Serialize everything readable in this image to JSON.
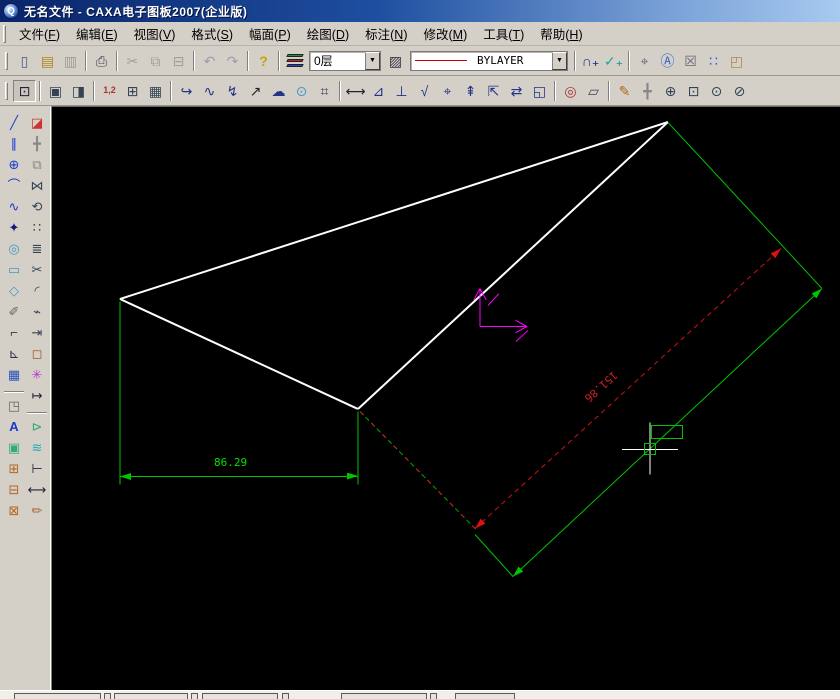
{
  "window": {
    "title": "无名文件 - CAXA电子图板2007(企业版)",
    "app_icon_glyph": "Q"
  },
  "menu": {
    "items": [
      {
        "pre": "文件(",
        "key": "F",
        "post": ")",
        "id": "file"
      },
      {
        "pre": "编辑(",
        "key": "E",
        "post": ")",
        "id": "edit"
      },
      {
        "pre": "视图(",
        "key": "V",
        "post": ")",
        "id": "view"
      },
      {
        "pre": "格式(",
        "key": "S",
        "post": ")",
        "id": "format"
      },
      {
        "pre": "幅面(",
        "key": "P",
        "post": ")",
        "id": "paper"
      },
      {
        "pre": "绘图(",
        "key": "D",
        "post": ")",
        "id": "draw"
      },
      {
        "pre": "标注(",
        "key": "N",
        "post": ")",
        "id": "dimension"
      },
      {
        "pre": "修改(",
        "key": "M",
        "post": ")",
        "id": "modify"
      },
      {
        "pre": "工具(",
        "key": "T",
        "post": ")",
        "id": "tools"
      },
      {
        "pre": "帮助(",
        "key": "H",
        "post": ")",
        "id": "help"
      }
    ]
  },
  "combos": {
    "layer": "0层",
    "linetype": "BYLAYER"
  },
  "colors": {
    "accent_green": "#00c400",
    "dim_text_green": "#00e400",
    "red": "#cc2222",
    "magenta": "#ff00ff",
    "white": "#ffffff",
    "linetype_sample": "#cc0000",
    "layer_icon": [
      "#2a8f2a",
      "#bb2222",
      "#2244cc"
    ]
  },
  "toolbar1": {
    "items": [
      {
        "n": "new-file-button",
        "g": "▯",
        "c": "#4a5a8a"
      },
      {
        "n": "open-file-button",
        "g": "▤",
        "c": "#b08820"
      },
      {
        "n": "save-file-button",
        "g": "▥",
        "c": "#707070",
        "gr": 1
      },
      {
        "sep": 1
      },
      {
        "n": "print-button",
        "g": "⎙",
        "c": "#445"
      },
      {
        "sep": 1
      },
      {
        "n": "cut-button",
        "g": "✂",
        "c": "#777",
        "gr": 1
      },
      {
        "n": "copy-button",
        "g": "⧉",
        "c": "#777",
        "gr": 1
      },
      {
        "n": "paste-button",
        "g": "⊟",
        "c": "#777",
        "gr": 1
      },
      {
        "sep": 1
      },
      {
        "n": "undo-button",
        "g": "↶",
        "c": "#6a74a0",
        "gr": 1
      },
      {
        "n": "redo-button",
        "g": "↷",
        "c": "#6a74a0",
        "gr": 1
      },
      {
        "sep": 1
      },
      {
        "n": "help-button",
        "g": "?",
        "c": "#c9a400",
        "bold": 1
      },
      {
        "sep": 1
      },
      {
        "type": "layers",
        "n": "layer-manager-button"
      },
      {
        "type": "combo",
        "n": "layer-combo",
        "bind": "combos.layer",
        "w": 72
      },
      {
        "n": "linetype-manager-button",
        "g": "▨",
        "c": "#334"
      },
      {
        "type": "combo",
        "n": "linetype-combo",
        "bind": "combos.linetype",
        "w": 158,
        "line": 1
      },
      {
        "sep": 1
      },
      {
        "n": "node-edit-button",
        "g": "∩₊",
        "c": "#223a8c",
        "bold": 1
      },
      {
        "n": "vector-edit-button",
        "g": "✓₊",
        "c": "#22a0a0",
        "bold": 1
      },
      {
        "sep": 1
      },
      {
        "n": "pan-view-button",
        "g": "⌖",
        "c": "#667"
      },
      {
        "n": "zoom-text-button",
        "g": "Ⓐ",
        "c": "#3366cc"
      },
      {
        "n": "view-rotate-button",
        "g": "☒",
        "c": "#667"
      },
      {
        "n": "refresh-view-button",
        "g": "∷",
        "c": "#3366cc"
      },
      {
        "n": "page-preview-button",
        "g": "◰",
        "c": "#b08850"
      }
    ]
  },
  "toolbar2": {
    "items": [
      {
        "n": "fit-view-button",
        "g": "⊡",
        "c": "#223",
        "pressed": 1
      },
      {
        "sep": 1
      },
      {
        "n": "frame-settings-button",
        "g": "▣",
        "c": "#345"
      },
      {
        "n": "title-block-button",
        "g": "◨",
        "c": "#345"
      },
      {
        "sep": 1
      },
      {
        "n": "dim-style-button",
        "g": "1,2",
        "c": "#a33",
        "small": 1
      },
      {
        "n": "table-button",
        "g": "⊞",
        "c": "#345"
      },
      {
        "n": "sheet-button",
        "g": "▦",
        "c": "#345"
      },
      {
        "sep": 1
      },
      {
        "n": "polyline-hook-button",
        "g": "↪",
        "c": "#238"
      },
      {
        "n": "wave-line-button",
        "g": "∿",
        "c": "#238"
      },
      {
        "n": "zigzag-line-button",
        "g": "↯",
        "c": "#238"
      },
      {
        "n": "arrow-tool-button",
        "g": "↗",
        "c": "#223"
      },
      {
        "n": "cloud-line-button",
        "g": "☁",
        "c": "#238"
      },
      {
        "n": "sketch-circle-button",
        "g": "⊙",
        "c": "#49c"
      },
      {
        "n": "symbol-tool-button",
        "g": "⌗",
        "c": "#345"
      },
      {
        "sep": 1
      },
      {
        "n": "linear-dim-button",
        "g": "⟷",
        "c": "#223"
      },
      {
        "n": "angular-dim-button",
        "g": "⊿",
        "c": "#238"
      },
      {
        "n": "datum-dim-button",
        "g": "⊥",
        "c": "#238"
      },
      {
        "n": "roughness-button",
        "g": "√",
        "c": "#238"
      },
      {
        "n": "tolerance-button",
        "g": "⌖",
        "c": "#238"
      },
      {
        "n": "weld-symbol-button",
        "g": "⇞",
        "c": "#238"
      },
      {
        "n": "section-symbol-button",
        "g": "⇱",
        "c": "#238"
      },
      {
        "n": "dim-edit-button",
        "g": "⇄",
        "c": "#238"
      },
      {
        "n": "dim-review-button",
        "g": "◱",
        "c": "#238"
      },
      {
        "sep": 1
      },
      {
        "n": "zoom-check-button",
        "g": "◎",
        "c": "#a33"
      },
      {
        "n": "measure-button",
        "g": "▱",
        "c": "#345"
      },
      {
        "sep": 1
      },
      {
        "n": "sketch-pen-button",
        "g": "✎",
        "c": "#b5651d"
      },
      {
        "n": "pan-hand-button",
        "g": "╋",
        "c": "#888"
      },
      {
        "n": "zoom-in-button",
        "g": "⊕",
        "c": "#345"
      },
      {
        "n": "zoom-window-button",
        "g": "⊡",
        "c": "#345"
      },
      {
        "n": "zoom-prev-button",
        "g": "⊙",
        "c": "#345"
      },
      {
        "n": "zoom-dynamic-button",
        "g": "⊘",
        "c": "#345"
      }
    ]
  },
  "left_toolbar": {
    "col_a": [
      {
        "n": "line-tool",
        "g": "╱",
        "c": "#1a3acc"
      },
      {
        "n": "parallel-line-tool",
        "g": "∥",
        "c": "#1a3acc"
      },
      {
        "n": "circle-tool",
        "g": "⊕",
        "c": "#1a3acc"
      },
      {
        "n": "arc-tool",
        "g": "⌒",
        "c": "#1a3acc"
      },
      {
        "n": "spline-tool",
        "g": "∿",
        "c": "#1a3acc"
      },
      {
        "n": "point-tool",
        "g": "✦",
        "c": "#15157a"
      },
      {
        "n": "ellipse-tool",
        "g": "◎",
        "c": "#4499bb"
      },
      {
        "n": "rectangle-tool",
        "g": "▭",
        "c": "#4499bb"
      },
      {
        "n": "polygon-tool",
        "g": "◇",
        "c": "#4499bb"
      },
      {
        "n": "hatch-pen-tool",
        "g": "✐",
        "c": "#666"
      },
      {
        "n": "polyline-tool",
        "g": "⌐",
        "c": "#334"
      },
      {
        "n": "axis-tool",
        "g": "⊾",
        "c": "#334"
      },
      {
        "n": "crosshatch-tool",
        "g": "▦",
        "c": "#2a52be"
      },
      {
        "n": "local-zoom-tool",
        "g": "◳",
        "c": "#666",
        "gap": 1
      },
      {
        "n": "text-tool",
        "g": "A",
        "c": "#1a3acc",
        "bold": 1
      },
      {
        "n": "block-tool",
        "g": "▣",
        "c": "#33aa77"
      },
      {
        "n": "block-create-tool",
        "g": "⊞",
        "c": "#b5651d"
      },
      {
        "n": "block-attr-tool",
        "g": "⊟",
        "c": "#b5651d"
      },
      {
        "n": "block-insert-tool",
        "g": "⊠",
        "c": "#b5651d"
      }
    ],
    "col_b": [
      {
        "n": "erase-tool",
        "g": "◪",
        "c": "#cc3333"
      },
      {
        "n": "move-tool",
        "g": "╋",
        "c": "#888"
      },
      {
        "n": "copy-tool",
        "g": "⧉",
        "c": "#888"
      },
      {
        "n": "mirror-tool",
        "g": "⋈",
        "c": "#345"
      },
      {
        "n": "rotate-tool",
        "g": "⟲",
        "c": "#345"
      },
      {
        "n": "array-tool",
        "g": "∷",
        "c": "#345"
      },
      {
        "n": "offset-tool",
        "g": "≣",
        "c": "#345"
      },
      {
        "n": "trim-tool",
        "g": "✂",
        "c": "#345"
      },
      {
        "n": "fillet-tool",
        "g": "◜",
        "c": "#345"
      },
      {
        "n": "break-tool",
        "g": "⌁",
        "c": "#345"
      },
      {
        "n": "extend-tool",
        "g": "⇥",
        "c": "#345"
      },
      {
        "n": "box-select-tool",
        "g": "◻",
        "c": "#aa5522"
      },
      {
        "n": "explode-tool",
        "g": "✳",
        "c": "#bb33cc"
      },
      {
        "n": "stretch-tool",
        "g": "↦",
        "c": "#223"
      },
      {
        "n": "block-move-tool",
        "g": "⊳",
        "c": "#33aa77",
        "gap": 1
      },
      {
        "n": "layer-change-tool",
        "g": "≋",
        "c": "#22aabb"
      },
      {
        "n": "align-dim-tool",
        "g": "⊢",
        "c": "#223"
      },
      {
        "n": "dim-arrows-tool",
        "g": "⟷",
        "c": "#223"
      },
      {
        "n": "format-brush-tool",
        "g": "✏",
        "c": "#aa6633"
      }
    ]
  },
  "canvas": {
    "origin": {
      "x": 52,
      "y": 106
    },
    "lines": [
      {
        "n": "triangle-edge-top",
        "x1": 668,
        "y1": 121,
        "x2": 120,
        "y2": 298,
        "c": "#ffffff",
        "w": 2
      },
      {
        "n": "triangle-edge-left",
        "x1": 120,
        "y1": 298,
        "x2": 358,
        "y2": 408,
        "c": "#ffffff",
        "w": 2
      },
      {
        "n": "triangle-edge-diagonal",
        "x1": 358,
        "y1": 408,
        "x2": 668,
        "y2": 121,
        "c": "#ffffff",
        "w": 2
      },
      {
        "n": "extension-line-left",
        "x1": 120,
        "y1": 300,
        "x2": 120,
        "y2": 483,
        "c": "#00c400",
        "w": 1
      },
      {
        "n": "extension-line-right",
        "x1": 358,
        "y1": 410,
        "x2": 358,
        "y2": 483,
        "c": "#00c400",
        "w": 1
      },
      {
        "n": "dimension-line-horizontal",
        "x1": 120,
        "y1": 475,
        "x2": 358,
        "y2": 475,
        "c": "#00c400",
        "w": 1
      },
      {
        "n": "aligned-extension-line-top",
        "x1": 668,
        "y1": 121,
        "x2": 822,
        "y2": 287,
        "c": "#00c400",
        "w": 1
      },
      {
        "n": "aligned-dimension-line",
        "x1": 822,
        "y1": 287,
        "x2": 513,
        "y2": 575,
        "c": "#00c400",
        "w": 1
      },
      {
        "n": "aligned-extension-line-bottom",
        "x1": 475,
        "y1": 533,
        "x2": 513,
        "y2": 575,
        "c": "#00c400",
        "w": 1
      },
      {
        "n": "mixed-dash-extension",
        "x1": 360,
        "y1": 410,
        "x2": 477,
        "y2": 529,
        "c": "#cc3322",
        "w": 1,
        "s": "mix"
      },
      {
        "n": "red-dash-dimension-line",
        "x1": 475,
        "y1": 527,
        "x2": 781,
        "y2": 247,
        "c": "#cc1111",
        "w": 1,
        "s": "dash"
      },
      {
        "n": "axis-marker-vertical",
        "x1": 480,
        "y1": 325,
        "x2": 480,
        "y2": 287,
        "c": "#ff00ff",
        "w": 1
      },
      {
        "n": "axis-marker-horizontal",
        "x1": 480,
        "y1": 325,
        "x2": 527,
        "y2": 325,
        "c": "#ff00ff",
        "w": 1
      },
      {
        "n": "axis-arrowhead-stroke",
        "x1": 480,
        "y1": 287,
        "x2": 474,
        "y2": 298,
        "c": "#ff00ff",
        "w": 1
      },
      {
        "n": "axis-arrowhead-stroke",
        "x1": 480,
        "y1": 287,
        "x2": 486,
        "y2": 298,
        "c": "#ff00ff",
        "w": 1
      },
      {
        "n": "axis-arrowhead-stroke",
        "x1": 527,
        "y1": 325,
        "x2": 516,
        "y2": 319,
        "c": "#ff00ff",
        "w": 1
      },
      {
        "n": "axis-arrowhead-stroke",
        "x1": 527,
        "y1": 325,
        "x2": 516,
        "y2": 331,
        "c": "#ff00ff",
        "w": 1
      },
      {
        "n": "axis-tick-stroke",
        "x1": 488,
        "y1": 304,
        "x2": 499,
        "y2": 292,
        "c": "#ff00ff",
        "w": 1
      },
      {
        "n": "axis-tick-stroke",
        "x1": 516,
        "y1": 340,
        "x2": 528,
        "y2": 329,
        "c": "#ff00ff",
        "w": 1
      },
      {
        "n": "crosshair-horizontal",
        "x1": 622,
        "y1": 448,
        "x2": 678,
        "y2": 448,
        "c": "#ffffff",
        "w": 1,
        "cursor": true
      },
      {
        "n": "crosshair-vertical",
        "x1": 650,
        "y1": 421,
        "x2": 650,
        "y2": 473,
        "c": "#ffffff",
        "w": 1,
        "cursor": true
      }
    ],
    "rects": [
      {
        "n": "dim-text-preview-box",
        "x": 651,
        "y": 424,
        "w": 32,
        "h": 14,
        "c": "#00c400"
      },
      {
        "n": "pick-box",
        "x": 644,
        "y": 442,
        "w": 12,
        "h": 12,
        "c": "#00c400",
        "cursor": true
      }
    ],
    "arrows": [
      {
        "n": "dim-arrow-left",
        "x": 120,
        "y": 475,
        "a": 180,
        "c": "#00c400"
      },
      {
        "n": "dim-arrow-right",
        "x": 358,
        "y": 475,
        "a": 0,
        "c": "#00c400"
      },
      {
        "n": "aligned-dim-arrow-top",
        "x": 822,
        "y": 287,
        "a": -43,
        "c": "#00c400"
      },
      {
        "n": "aligned-dim-arrow-bottom",
        "x": 513,
        "y": 575,
        "a": 137,
        "c": "#00c400"
      },
      {
        "n": "red-dim-arrow-top",
        "x": 781,
        "y": 247,
        "a": -42.5,
        "c": "#dd1111"
      },
      {
        "n": "red-dim-arrow-bottom",
        "x": 475,
        "y": 527,
        "a": 137.5,
        "c": "#dd1111"
      }
    ],
    "texts": [
      {
        "n": "dim-text-horizontal",
        "x": 214,
        "y": 455,
        "t": "86.29",
        "c": "#00e400",
        "r": 0
      },
      {
        "n": "dim-text-aligned",
        "x": 581,
        "y": 379,
        "t": "151.86",
        "c": "#cc2222",
        "r": 138
      }
    ]
  },
  "bottom_strip": {
    "boxes": [
      {
        "x": 14,
        "w": 87
      },
      {
        "x": 104,
        "w": 7
      },
      {
        "x": 114,
        "w": 74
      },
      {
        "x": 191,
        "w": 7
      },
      {
        "x": 202,
        "w": 76
      },
      {
        "x": 282,
        "w": 7
      },
      {
        "x": 341,
        "w": 86
      },
      {
        "x": 430,
        "w": 7
      },
      {
        "x": 455,
        "w": 60
      }
    ]
  }
}
